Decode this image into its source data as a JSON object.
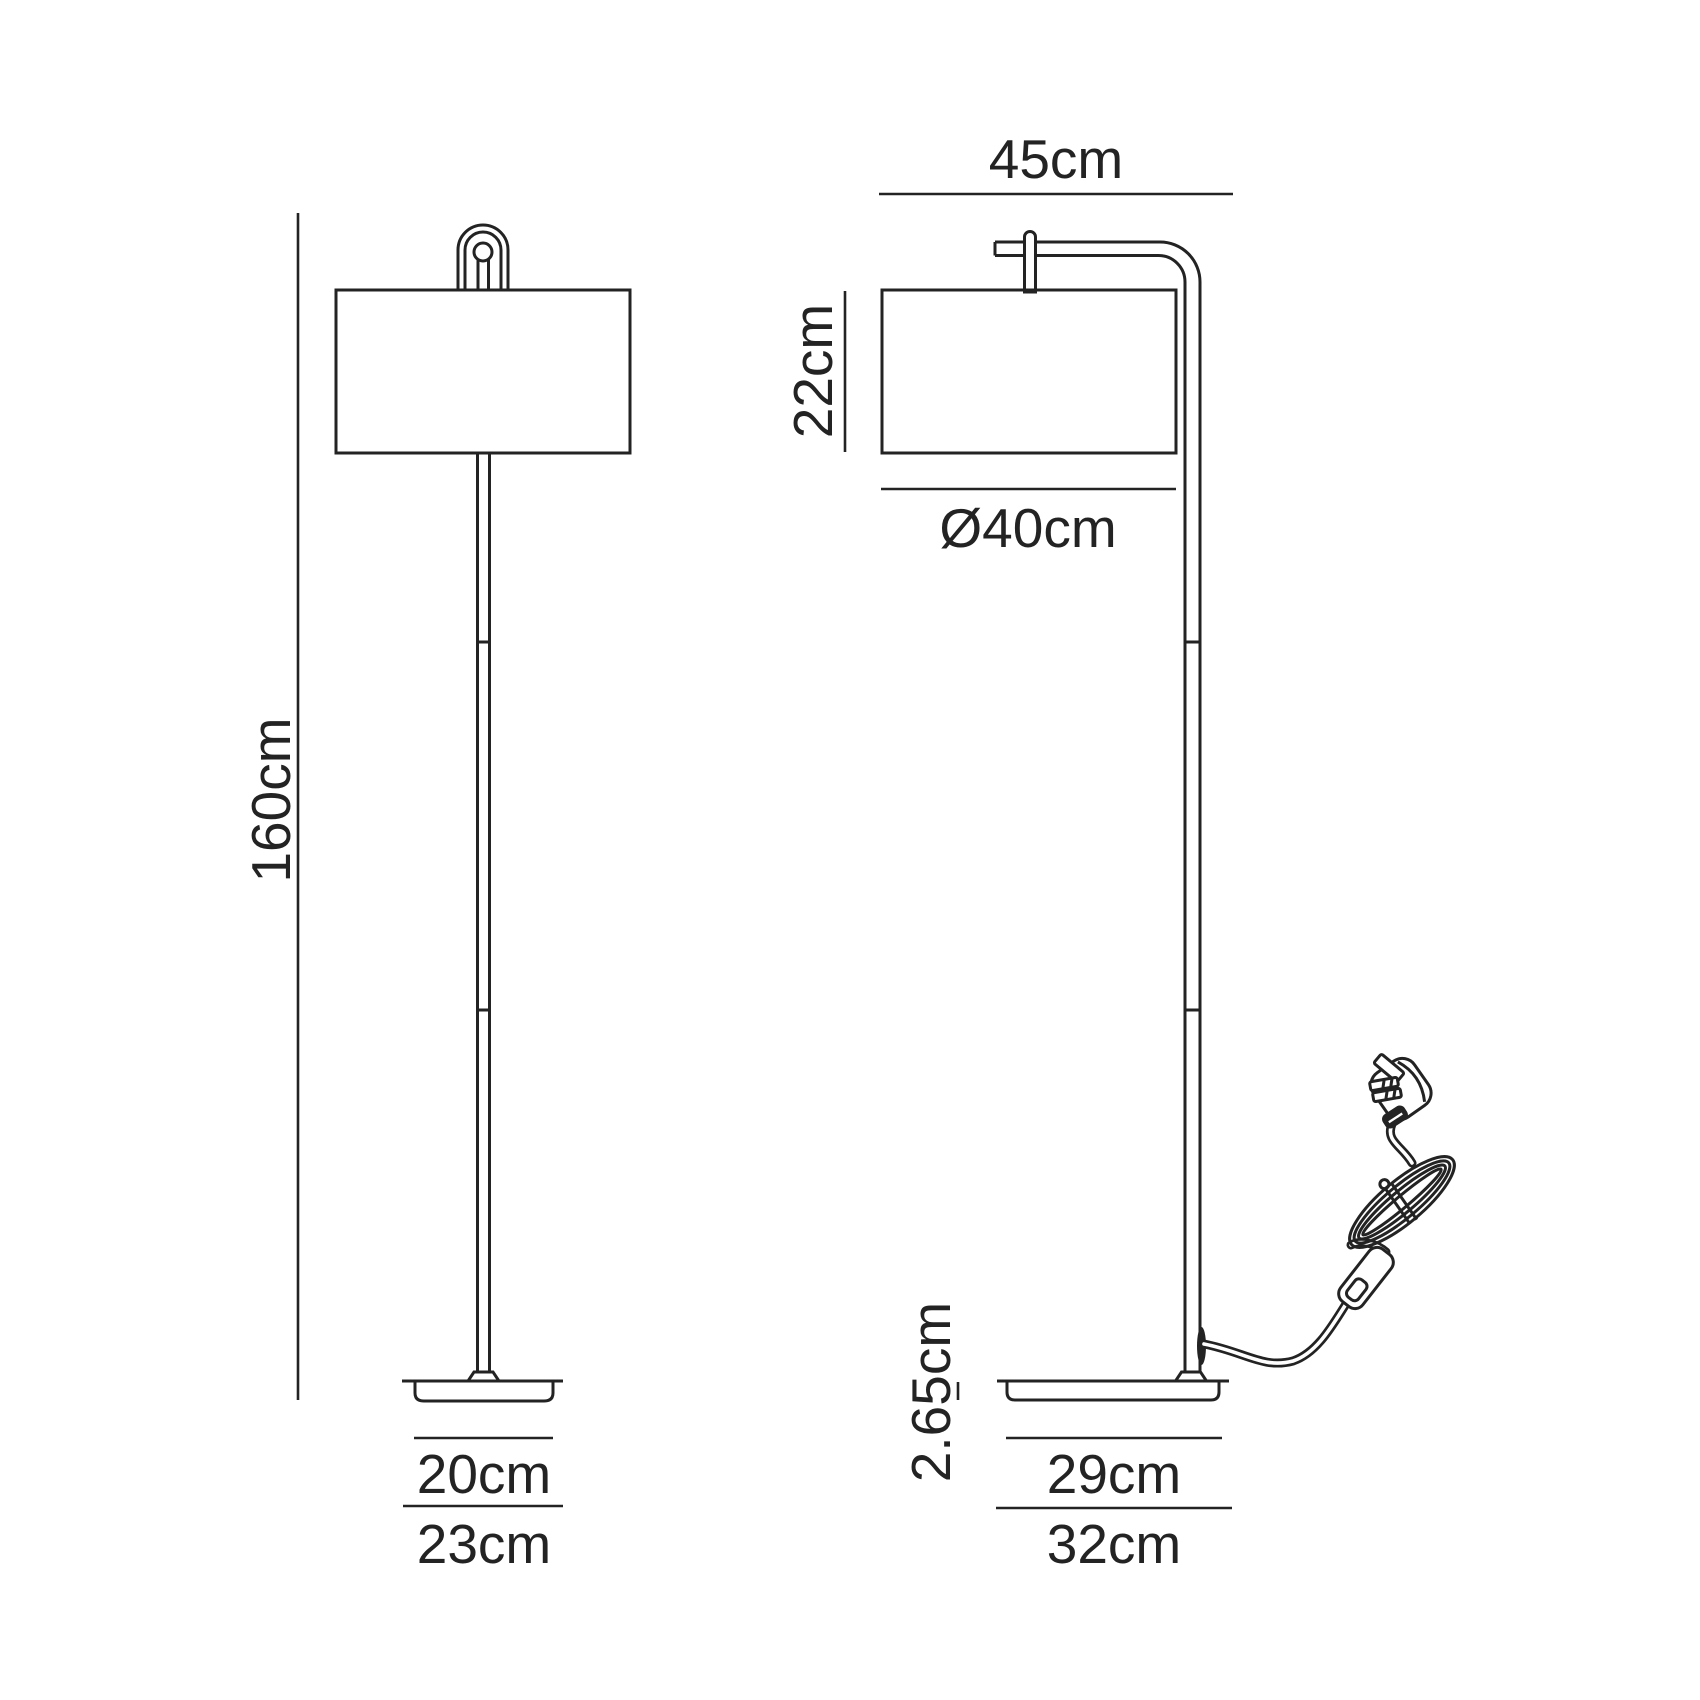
{
  "diagram": {
    "ink_color": "#232323",
    "background_color": "#ffffff",
    "front_view": {
      "overall_height": "160cm",
      "base_inner_width": "20cm",
      "base_outer_width": "23cm"
    },
    "side_view": {
      "overall_depth": "45cm",
      "shade_height": "22cm",
      "shade_diameter": "Ø40cm",
      "base_thickness": "2.65cm",
      "base_inner_depth": "29cm",
      "base_outer_depth": "32cm"
    }
  }
}
